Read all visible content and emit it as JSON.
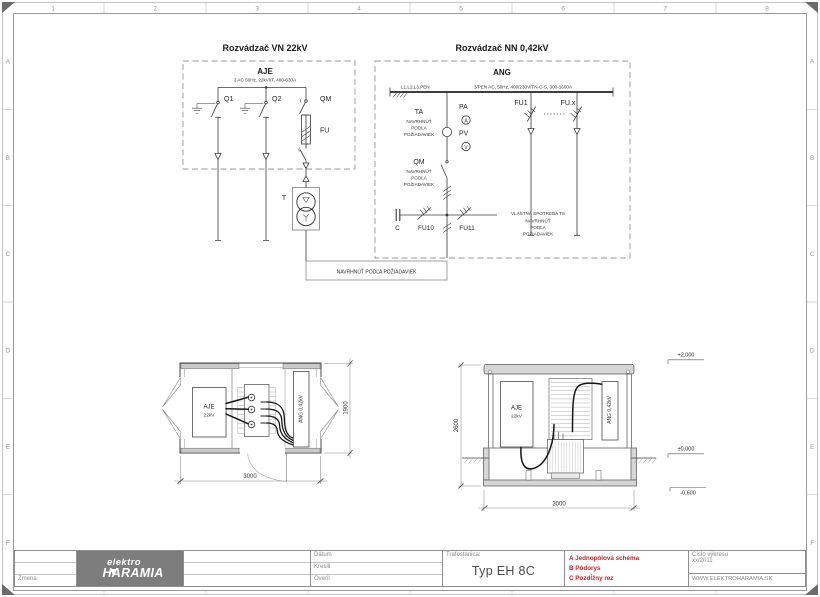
{
  "frame": {
    "cols": [
      "1",
      "2",
      "3",
      "4",
      "5",
      "6",
      "7",
      "8"
    ],
    "rows": [
      "A",
      "B",
      "C",
      "D",
      "E",
      "F"
    ]
  },
  "colors": {
    "accent_red": "#c5232b",
    "logo_gray": "#7d7d7d"
  },
  "vn": {
    "title": "Rozvádzač VN 22kV",
    "panel": "AJE",
    "spec": "3 AC 50Hz, 22kV/IT, 400-630A",
    "q1": "Q1",
    "q2": "Q2",
    "qm": "QM",
    "fu": "FU",
    "t": "T"
  },
  "nn": {
    "title": "Rozvádzač NN 0,42kV",
    "panel": "ANG",
    "conductors": "L1,L2,L3,PEN",
    "spec": "3/PEN AC, 50Hz, 400/230V/TN-C-S, 300-1600A",
    "ta": "TA",
    "pa": "PA",
    "pa_sym": "A",
    "pv": "PV",
    "pv_sym": "V",
    "fu1": "FU1",
    "fux": "FU.x",
    "qm": "QM",
    "c": "C",
    "fu10": "FU10",
    "fu11": "FU11",
    "own_use": "VLASTNÁ SPOTREBA TS",
    "note_lines": [
      "NAVRHNÚŤ",
      "PODĽA",
      "POŽIADAVIEK"
    ]
  },
  "note_box": "NAVRHNÚŤ PODĽA POŽIADAVIEK",
  "plan": {
    "aje": "AJE",
    "aje_kv": "22kV",
    "ang": "ANG  0,42kV",
    "dim_w": "3000",
    "dim_h": "1900"
  },
  "section": {
    "aje": "AJE",
    "aje_kv": "22kV",
    "ang": "ANG  0,42kV",
    "dim_h": "2600",
    "dim_w": "3000",
    "lvl_top": "+2,000",
    "lvl_zero": "±0,000",
    "lvl_low": "-0,600"
  },
  "titleblock": {
    "zmena": "Zmena",
    "logo1": "elektro",
    "logo2": "HARAMIA",
    "datum": "Dátum",
    "kreslil": "Kreslil",
    "overil": "Overil",
    "trafostanica": "Trafostanica:",
    "typ": "Typ EH 8C",
    "items": [
      "A Jednopólová schéma",
      "B Pôdorys",
      "C Pozdĺžny rez"
    ],
    "cislo_label": "Číslo výkresu",
    "cislo": "xx/2011",
    "web": "WWW.ELEKTROHARAMIA.SK"
  }
}
